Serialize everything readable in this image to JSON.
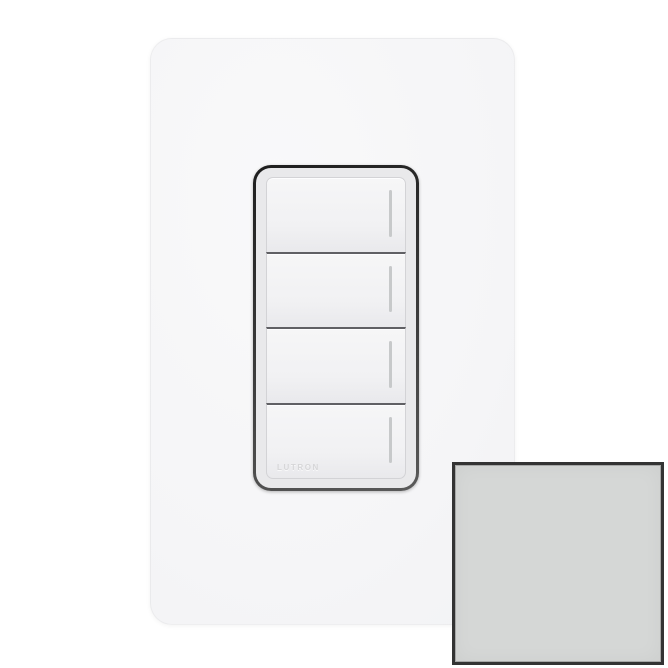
{
  "product_photo": {
    "brand_engraving": "LUTRON",
    "keypad_button_count": 4,
    "led_slot_count": 4
  },
  "swatch": {
    "fill_color": "#d5d7d6",
    "border_color": "#333333"
  },
  "colors": {
    "background": "#ffffff",
    "wallplate": "#f5f5f7",
    "keypad_bezel": "#343434",
    "keypad_face": "#e9e9eb",
    "button_face": "#f2f2f3",
    "button_divider": "#606064",
    "led_slot": "#c7c9ca",
    "engraving_text": "#d6d6d8"
  }
}
